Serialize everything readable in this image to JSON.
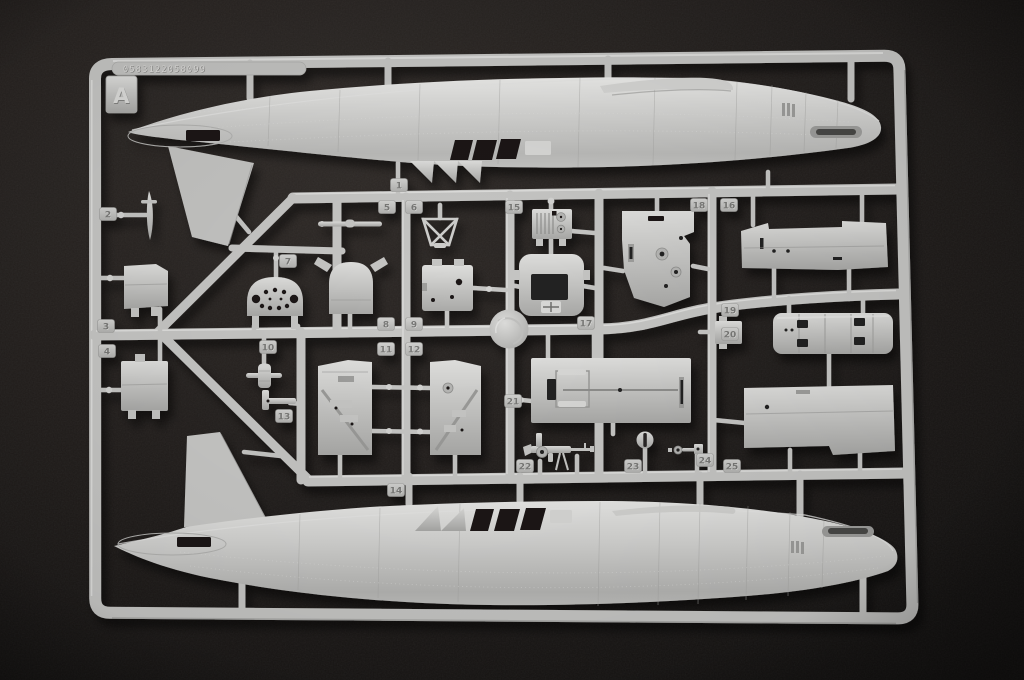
{
  "sprue": {
    "letter": "A",
    "mold_code": "0583122058099",
    "colors": {
      "plastic": "#c6c6c4",
      "plastic_light": "#e4e4e2",
      "plastic_dark": "#9c9c9a",
      "background": "#262220",
      "background_edge": "#141211",
      "recess": "#1a1817"
    },
    "part_tags": [
      {
        "label": "1",
        "x": 399,
        "y": 185
      },
      {
        "label": "2",
        "x": 108,
        "y": 214
      },
      {
        "label": "3",
        "x": 106,
        "y": 326
      },
      {
        "label": "4",
        "x": 107,
        "y": 351
      },
      {
        "label": "5",
        "x": 387,
        "y": 207
      },
      {
        "label": "6",
        "x": 414,
        "y": 207
      },
      {
        "label": "7",
        "x": 288,
        "y": 261
      },
      {
        "label": "8",
        "x": 386,
        "y": 324
      },
      {
        "label": "9",
        "x": 414,
        "y": 324
      },
      {
        "label": "10",
        "x": 268,
        "y": 347
      },
      {
        "label": "11",
        "x": 386,
        "y": 349
      },
      {
        "label": "12",
        "x": 414,
        "y": 349
      },
      {
        "label": "13",
        "x": 284,
        "y": 416
      },
      {
        "label": "14",
        "x": 396,
        "y": 490
      },
      {
        "label": "15",
        "x": 514,
        "y": 207
      },
      {
        "label": "16",
        "x": 729,
        "y": 205
      },
      {
        "label": "17",
        "x": 586,
        "y": 323
      },
      {
        "label": "18",
        "x": 699,
        "y": 205
      },
      {
        "label": "19",
        "x": 730,
        "y": 310
      },
      {
        "label": "20",
        "x": 730,
        "y": 334
      },
      {
        "label": "21",
        "x": 513,
        "y": 401
      },
      {
        "label": "22",
        "x": 525,
        "y": 466
      },
      {
        "label": "23",
        "x": 633,
        "y": 466
      },
      {
        "label": "24",
        "x": 705,
        "y": 460
      },
      {
        "label": "25",
        "x": 732,
        "y": 466
      }
    ]
  }
}
